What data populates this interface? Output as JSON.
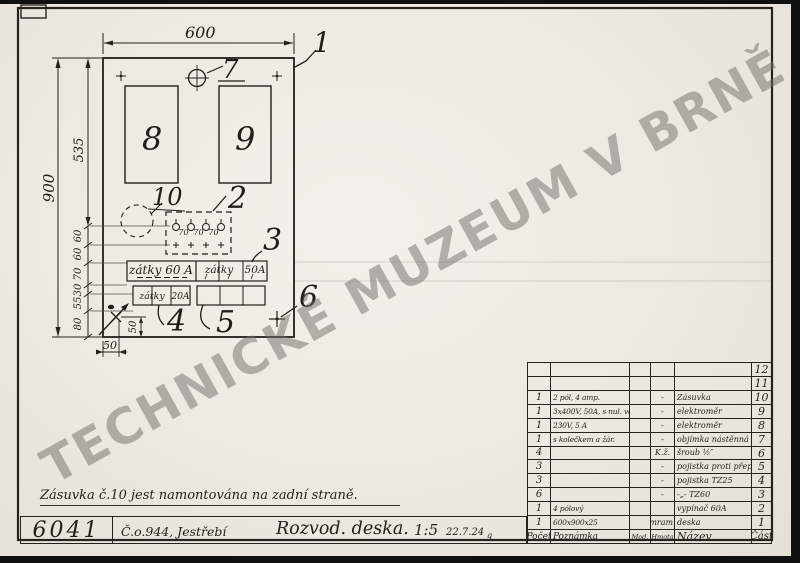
{
  "watermark": "TECHNICKÉ MUZEUM V BRNĚ",
  "note": "Zásuvka č.10 jest namontována na zadní straně.",
  "title_block": {
    "drawing_number": "6041",
    "order": "Č.o.944, Jestřebí",
    "title": "Rozvod. deska.",
    "scale": "1:5",
    "date": "22.7.24",
    "date_mark": "g"
  },
  "drawing": {
    "dim_width": "600",
    "dim_height": "900",
    "dim_top_section": "535",
    "dim_chain": [
      "60",
      "60",
      "70",
      "30",
      "55",
      "80"
    ],
    "dim_spacing": "70",
    "dim_bottom": "50",
    "dim_hole": "50",
    "callouts": {
      "c1": "1",
      "c2": "2",
      "c3": "3",
      "c4": "4",
      "c5": "5",
      "c6": "6",
      "c7": "7",
      "c8": "8",
      "c9": "9",
      "c10": "10"
    },
    "labels": {
      "strip1_left": "zátky 60 A",
      "strip1_right": "zátky",
      "strip1_amp": "50A",
      "strip2_left": "zátky",
      "strip2_amp": "20A"
    }
  },
  "table": {
    "headers": {
      "pocet": "Počet",
      "poznamka": "Poznámka",
      "mod": "Mod.",
      "hmota": "Hmota",
      "nazev": "Název",
      "cast": "Část"
    },
    "rows": [
      {
        "pocet": "",
        "poznamka": "",
        "mod": "",
        "hmota": "",
        "nazev": "",
        "cast": "12"
      },
      {
        "pocet": "",
        "poznamka": "",
        "mod": "",
        "hmota": "",
        "nazev": "",
        "cast": "11"
      },
      {
        "pocet": "1",
        "poznamka": "2 pól, 4 amp.",
        "mod": "",
        "hmota": "-",
        "nazev": "Zásuvka",
        "cast": "10"
      },
      {
        "pocet": "1",
        "poznamka": "3x400V, 50A, s nul. vod.",
        "mod": "",
        "hmota": "-",
        "nazev": "elektroměr",
        "cast": "9"
      },
      {
        "pocet": "1",
        "poznamka": "230V, 5 A",
        "mod": "",
        "hmota": "-",
        "nazev": "elektroměr",
        "cast": "8"
      },
      {
        "pocet": "1",
        "poznamka": "s kolečkem a žár.",
        "mod": "",
        "hmota": "-",
        "nazev": "objímka nástěnná",
        "cast": "7"
      },
      {
        "pocet": "4",
        "poznamka": "",
        "mod": "",
        "hmota": "K.ž.",
        "nazev": "šroub ½″",
        "cast": "6"
      },
      {
        "pocet": "3",
        "poznamka": "",
        "mod": "",
        "hmota": "-",
        "nazev": "pojistka proti přepětí",
        "cast": "5"
      },
      {
        "pocet": "3",
        "poznamka": "",
        "mod": "",
        "hmota": "-",
        "nazev": "pojistka TZ25",
        "cast": "4"
      },
      {
        "pocet": "6",
        "poznamka": "",
        "mod": "",
        "hmota": "-",
        "nazev": "-„- TZ60",
        "cast": "3"
      },
      {
        "pocet": "1",
        "poznamka": "4 pólový",
        "mod": "",
        "hmota": "",
        "nazev": "vypínač 60A",
        "cast": "2"
      },
      {
        "pocet": "1",
        "poznamka": "600x900x25",
        "mod": "",
        "hmota": "mram.",
        "nazev": "deska",
        "cast": "1"
      }
    ]
  }
}
